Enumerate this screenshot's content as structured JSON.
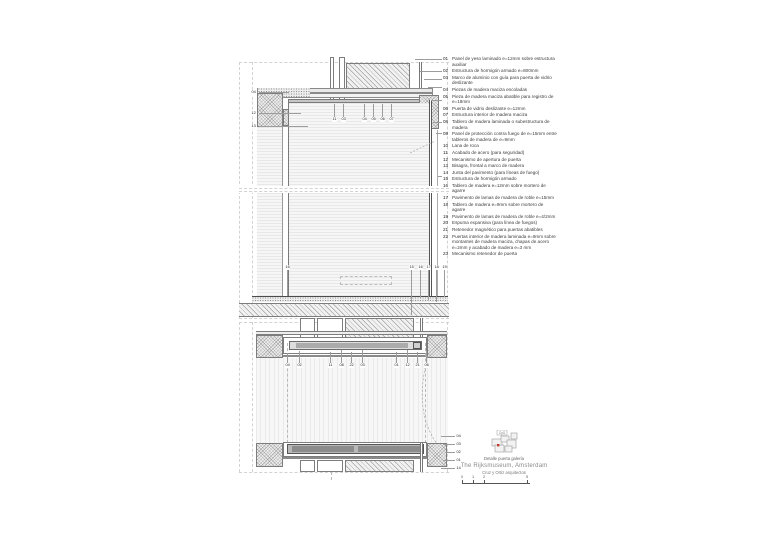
{
  "sheet": {
    "caption": "Detalle puerta galería",
    "title": "The Rijksmuseum, Amsterdam",
    "architect": "Cruz y Ortiz arquitectos",
    "plan_icon_label": "CyO"
  },
  "legend": {
    "items": [
      {
        "num": "01",
        "text": "Panel de yeso laminado e=12mm sobre estructura auxiliar"
      },
      {
        "num": "02",
        "text": "Estructura de hormigón armado e=800mm"
      },
      {
        "num": "03",
        "text": "Marco de aluminio con guía para puerta de vidrio deslizante"
      },
      {
        "num": "04",
        "text": "Piezas de madera maciza encoladas"
      },
      {
        "num": "05",
        "text": "Pieza de madera maciza abatible para registro de e=18mm"
      },
      {
        "num": "06",
        "text": "Puerta de vidrio deslizante e=12mm"
      },
      {
        "num": "07",
        "text": "Estructura interior de madera maciza"
      },
      {
        "num": "08",
        "text": "Tablero de madera laminada o subestructura de madera"
      },
      {
        "num": "09",
        "text": "Panel de protección contra fuego de e=15mm entre tableros de madera de e=9mm"
      },
      {
        "num": "10",
        "text": "Lana de roca"
      },
      {
        "num": "11",
        "text": "Acabado de acero (para seguridad)"
      },
      {
        "num": "12",
        "text": "Mecanismo de apertura de puerta"
      },
      {
        "num": "13",
        "text": "Bisagra, frontal a marco de madera"
      },
      {
        "num": "14",
        "text": "Junta del pavimento (para líneas de fuego)"
      },
      {
        "num": "15",
        "text": "Estructura de hormigón armado"
      },
      {
        "num": "16",
        "text": "Tablero de madera e=12mm sobre mortero de agarre"
      },
      {
        "num": "17",
        "text": "Pavimento de lamas de madera de roble e=15mm"
      },
      {
        "num": "18",
        "text": "Tablero de madera e=9mm sobre mortero de agarre"
      },
      {
        "num": "19",
        "text": "Pavimento de lamas de madera de roble e=4/2mm"
      },
      {
        "num": "20",
        "text": "Espuma expansiva (para línea de fuegos)"
      },
      {
        "num": "21",
        "text": "Retenedor magnético para puertas abatibles"
      },
      {
        "num": "22",
        "text": "Puertas interior de madera laminada e=9mm sobre montantes de madera maciza, chapas de acero e=2mm y acabado de madera e=3 mm"
      },
      {
        "num": "23",
        "text": "Mecanismo retenedor de puerta"
      }
    ],
    "leaders": [
      {
        "x": 415,
        "y": 59,
        "w": 27
      },
      {
        "x": 420,
        "y": 71,
        "w": 22
      },
      {
        "x": 424,
        "y": 79,
        "w": 18
      },
      {
        "x": 428,
        "y": 87,
        "w": 14
      },
      {
        "x": 431,
        "y": 100,
        "w": 11
      },
      {
        "x": 433,
        "y": 122,
        "w": 9
      },
      {
        "x": 436,
        "y": 133,
        "w": 6
      },
      {
        "x": 438,
        "y": 176,
        "w": 4
      }
    ]
  },
  "callouts": {
    "section_top": {
      "dir": "up",
      "y": 117,
      "len": 13,
      "items": [
        {
          "label": "11",
          "x": 332
        },
        {
          "label": "03",
          "x": 341
        },
        {
          "label": "04",
          "x": 362
        },
        {
          "label": "05",
          "x": 371
        },
        {
          "label": "06",
          "x": 380
        },
        {
          "label": "07",
          "x": 389
        }
      ]
    },
    "section_left": {
      "dir": "right",
      "x": 251,
      "items": [
        {
          "label": "04",
          "y": 90,
          "len": 30
        },
        {
          "label": "12",
          "y": 111,
          "len": 42
        },
        {
          "label": "13",
          "y": 124,
          "len": 49
        }
      ]
    },
    "section_bottom": {
      "dir": "down",
      "y": 265,
      "items": [
        {
          "label": "16",
          "x": 285,
          "len": 26
        },
        {
          "label": "15",
          "x": 409,
          "len": 45
        },
        {
          "label": "16",
          "x": 418,
          "len": 28
        },
        {
          "label": "17",
          "x": 426,
          "len": 30
        },
        {
          "label": "18",
          "x": 434,
          "len": 32
        },
        {
          "label": "19",
          "x": 442,
          "len": 27
        }
      ]
    },
    "plan_row": {
      "dir": "up",
      "y": 363,
      "items": [
        {
          "label": "04",
          "x": 285,
          "len": 10
        },
        {
          "label": "02",
          "x": 297,
          "len": 12
        },
        {
          "label": "11",
          "x": 328,
          "len": 11
        },
        {
          "label": "08",
          "x": 339,
          "len": 13
        },
        {
          "label": "22",
          "x": 349,
          "len": 11
        },
        {
          "label": "03",
          "x": 360,
          "len": 13
        },
        {
          "label": "01",
          "x": 394,
          "len": 11
        },
        {
          "label": "12",
          "x": 405,
          "len": 13
        },
        {
          "label": "21",
          "x": 415,
          "len": 11
        },
        {
          "label": "06",
          "x": 424,
          "len": 13
        }
      ]
    },
    "plan_right": {
      "dir": "left",
      "x": 456,
      "items": [
        {
          "label": "04",
          "y": 434,
          "len": 14
        },
        {
          "label": "03",
          "y": 442,
          "len": 12
        },
        {
          "label": "02",
          "y": 450,
          "len": 10
        },
        {
          "label": "01",
          "y": 458,
          "len": 12
        },
        {
          "label": "14",
          "y": 466,
          "len": 14
        }
      ]
    }
  },
  "scale_bar": {
    "labels": [
      {
        "t": "0",
        "x": 0
      },
      {
        "t": "1",
        "x": 11
      },
      {
        "t": "2",
        "x": 22
      },
      {
        "t": "5",
        "x": 65
      }
    ]
  },
  "colors": {
    "line": "#6e6e6e",
    "dark_line": "#444444",
    "hatch": "#8f8f8f",
    "marker_red": "#c0392b"
  }
}
